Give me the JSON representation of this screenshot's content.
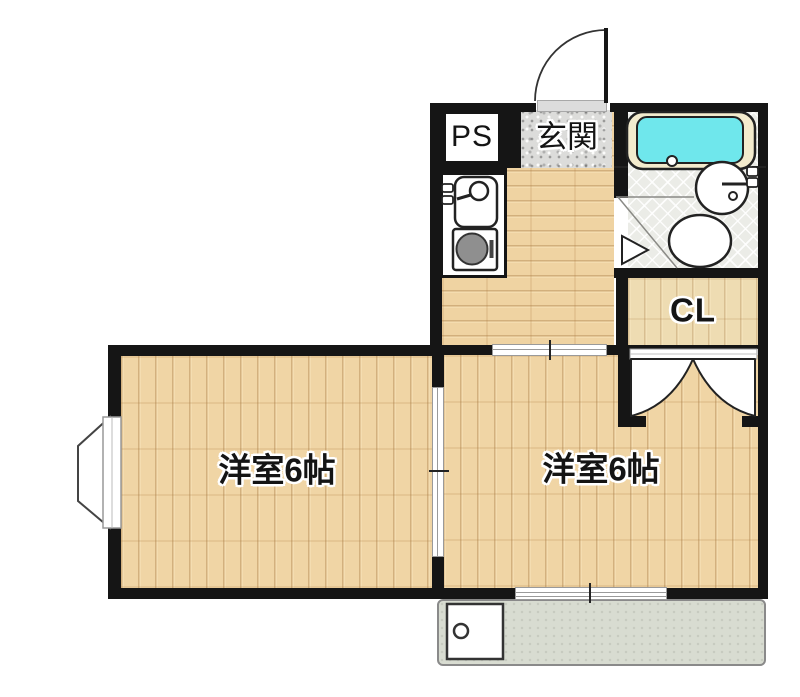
{
  "plan": {
    "labels": {
      "pipe_space": "PS",
      "entrance": "玄関",
      "closet": "CL",
      "room_left": "洋室6帖",
      "room_right": "洋室6帖"
    },
    "colors": {
      "wall": "#151515",
      "wood_floor": "#f0d5a5",
      "closet_floor": "#eedcb2",
      "bathtub_water": "#6fe7ec",
      "bathtub_rim": "#f3ebcd",
      "entrance_floor": "#dcdcda",
      "bathroom_floor": "#ebece7",
      "balcony_floor": "#d8dcd1"
    }
  }
}
